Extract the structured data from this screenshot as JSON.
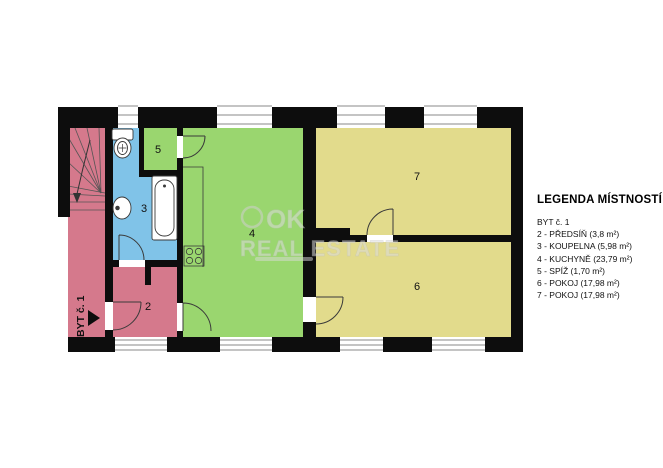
{
  "legend": {
    "title": "LEGENDA MÍSTNOSTÍ",
    "items": [
      "BYT č. 1",
      "2 - PŘEDSÍŇ (3,8 m²)",
      "3 - KOUPELNA (5,98 m²)",
      "4 - KUCHYNĚ (23,79 m²)",
      "5 - SPÍŽ (1,70 m²)",
      "6 - POKOJ (17,98 m²)",
      "7 - POKOJ (17,98 m²)"
    ]
  },
  "plan": {
    "unit_arrow_label": "BYT č. 1",
    "room_numbers": {
      "hall": "2",
      "bathroom": "3",
      "kitchen": "4",
      "pantry": "5",
      "room6": "6",
      "room7": "7"
    }
  },
  "watermark": {
    "logo": "OK",
    "name": "REAL ESTATE"
  },
  "colors": {
    "pink": "#d5798c",
    "blue": "#80c3e8",
    "green": "#9ad66f",
    "yellow": "#e2db8c",
    "wall": "#0d0d0d"
  }
}
